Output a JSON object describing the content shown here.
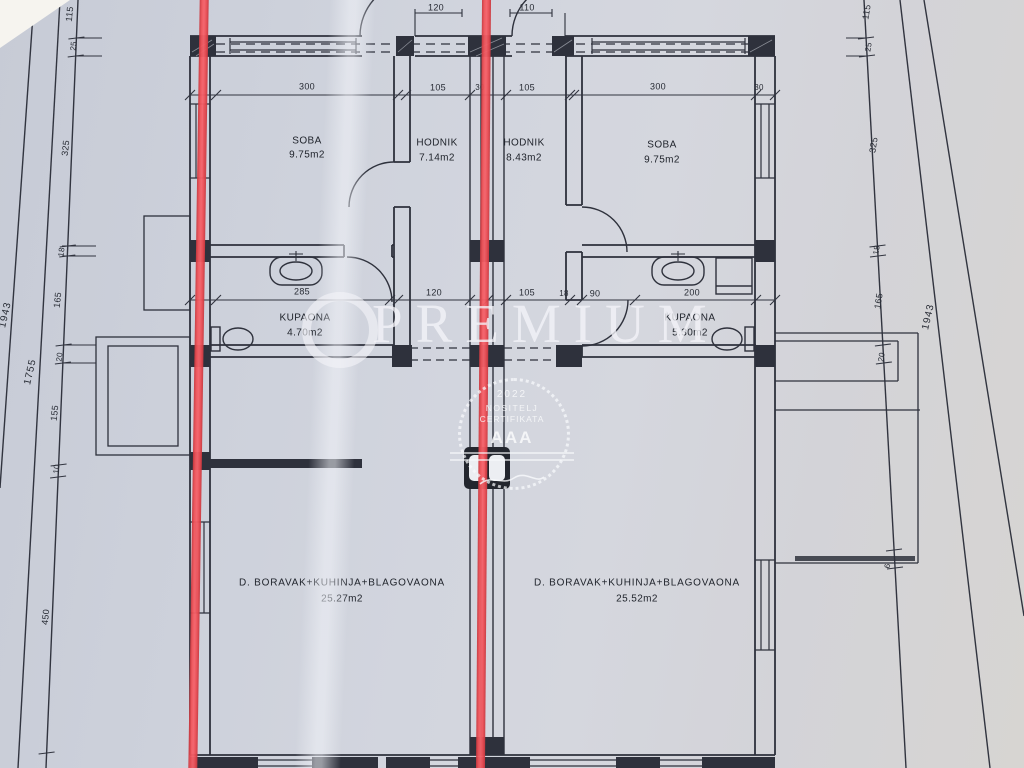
{
  "watermark": {
    "brand": "PREMIUM",
    "stamp": {
      "year": "2022",
      "line1": "NOSITELJ",
      "line2": "CERTIFIKATA",
      "logo": "AAA"
    }
  },
  "rooms": {
    "soba_left": {
      "name": "SOBA",
      "area": "9.75m2"
    },
    "hodnik_left": {
      "name": "HODNIK",
      "area": "7.14m2"
    },
    "hodnik_right": {
      "name": "HODNIK",
      "area": "8.43m2"
    },
    "soba_right": {
      "name": "SOBA",
      "area": "9.75m2"
    },
    "kupaona_left": {
      "name": "KUPAONA",
      "area": "4.70m2"
    },
    "kupaona_right": {
      "name": "KUPAONA",
      "area": "5.30m2"
    },
    "living_left": {
      "name": "D. BORAVAK+KUHINJA+BLAGOVAONA",
      "area": "25.27m2"
    },
    "living_right": {
      "name": "D. BORAVAK+KUHINJA+BLAGOVAONA",
      "area": "25.52m2"
    }
  },
  "dims": {
    "left": [
      "115",
      "25",
      "325",
      "18",
      "165",
      "20",
      "155",
      "10",
      "450"
    ],
    "right": [
      "115",
      "25",
      "325",
      "18",
      "165",
      "20",
      "6"
    ],
    "total_left": "1943",
    "total_left_inner": "1755",
    "total_right": "1943",
    "door_left": "120",
    "door_right": "110",
    "top_row": [
      "300",
      "105",
      "105",
      "300"
    ],
    "top_row_small": [
      "30",
      "30"
    ],
    "mid_row": [
      "285",
      "120",
      "105",
      "90",
      "200"
    ],
    "mid_row_small": [
      "18"
    ]
  },
  "colors": {
    "red_section_line": "#e8474e",
    "ink": "#2e313c",
    "paper": "#ced2db",
    "watermark_white": "#f2f3f7"
  }
}
